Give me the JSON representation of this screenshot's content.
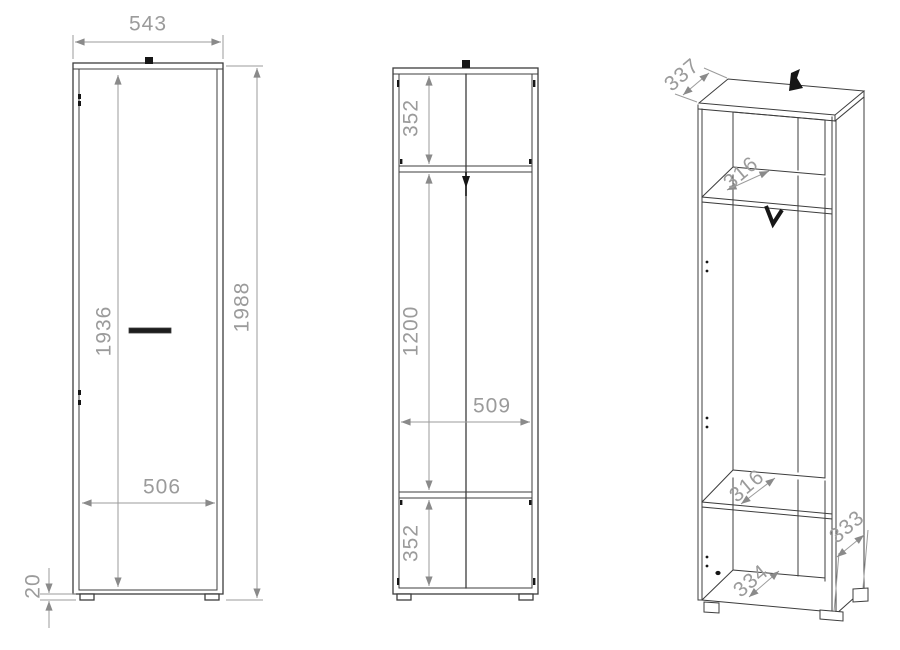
{
  "colors": {
    "background": "#ffffff",
    "line": "#3d3d3d",
    "dim": "#9b9b9b",
    "accent": "#161616",
    "arrow": "#8a8a8a"
  },
  "views": {
    "front": {
      "dims": {
        "width": "543",
        "total_height": "1988",
        "door_height": "1936",
        "base_width": "506",
        "foot_height": "20"
      }
    },
    "carcass": {
      "dims": {
        "top_section_height": "352",
        "middle_section_height": "1200",
        "interior_width": "509",
        "bottom_section_height": "352"
      }
    },
    "perspective": {
      "dims": {
        "top_depth": "337",
        "upper_shelf_depth": "316",
        "lower_shelf_depth": "316",
        "bottom_depth": "334",
        "side_depth": "333"
      }
    }
  }
}
